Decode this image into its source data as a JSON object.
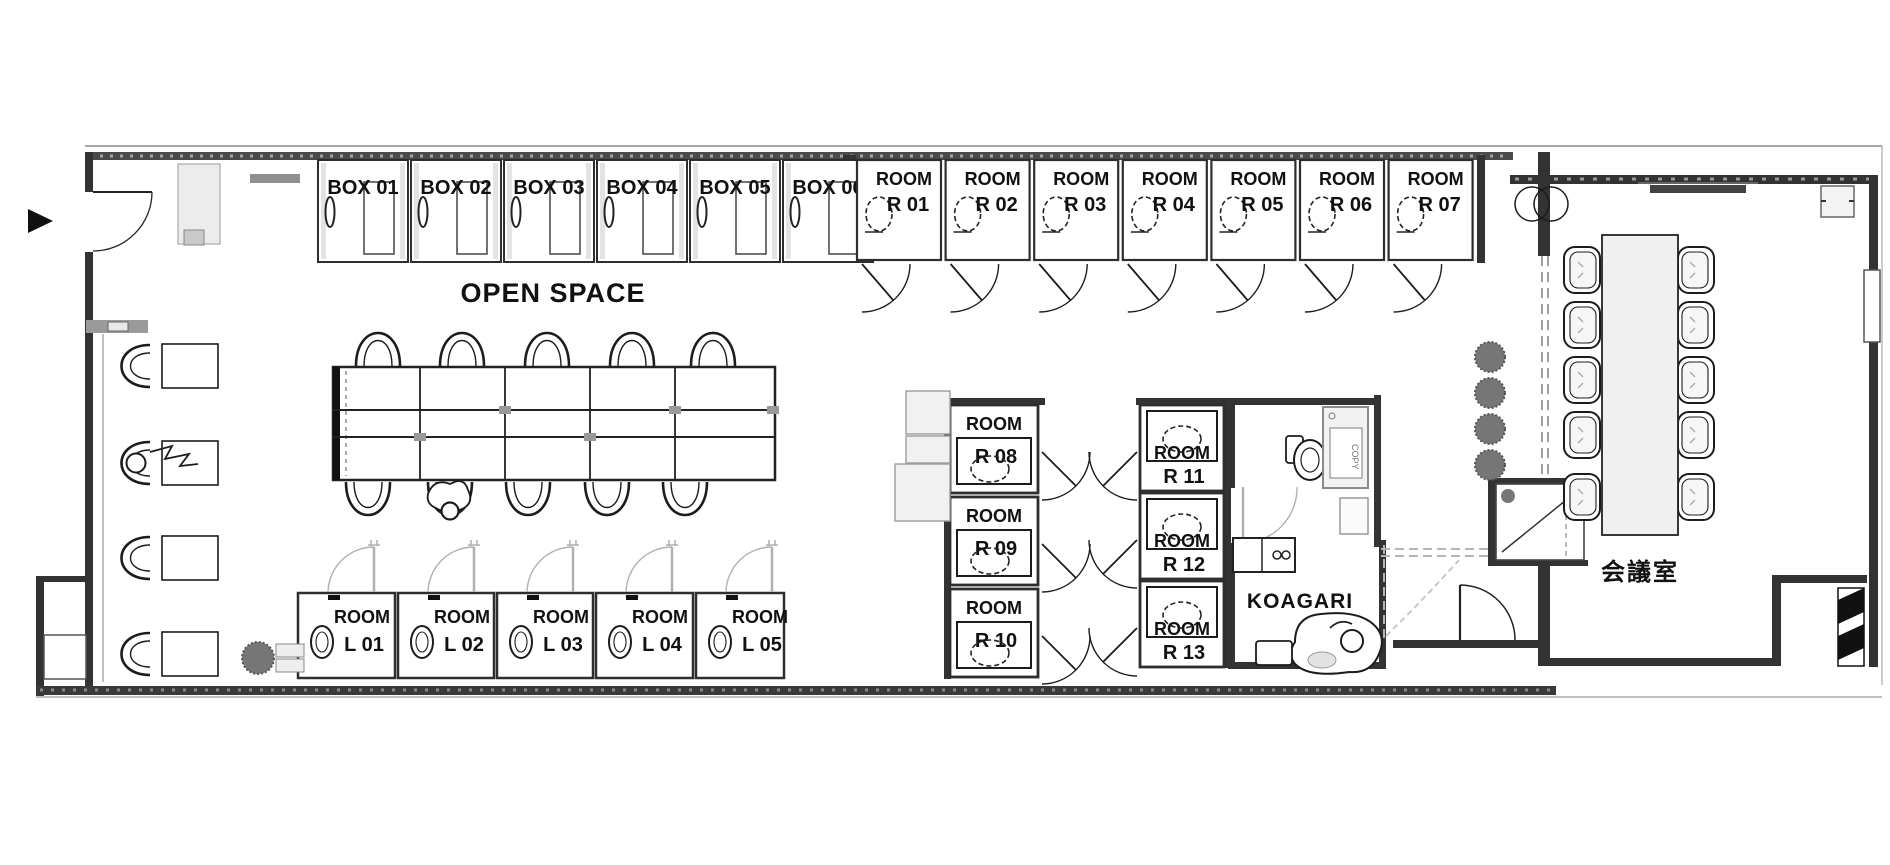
{
  "plan": {
    "open_space_label": "OPEN SPACE",
    "meeting_room_label": "会議室",
    "koagari_label": "KOAGARI",
    "copier_label": "COPY",
    "room_word": "ROOM",
    "box_rooms": [
      "BOX 01",
      "BOX 02",
      "BOX 03",
      "BOX 04",
      "BOX 05",
      "BOX 06"
    ],
    "top_room_ids": [
      "R 01",
      "R 02",
      "R 03",
      "R 04",
      "R 05",
      "R 06",
      "R 07"
    ],
    "bottom_room_ids": [
      "L 01",
      "L 02",
      "L 03",
      "L 04",
      "L 05"
    ],
    "mid_left_room_ids": [
      "R 08",
      "R 09",
      "R 10"
    ],
    "mid_right_room_ids": [
      "R 11",
      "R 12",
      "R 13"
    ]
  },
  "colors": {
    "wall": "#3a3a3a",
    "line": "#1c1c1c",
    "door_gray": "#b0b0b0",
    "plant": "#767676",
    "furniture_fill": "#f0f0f0"
  }
}
